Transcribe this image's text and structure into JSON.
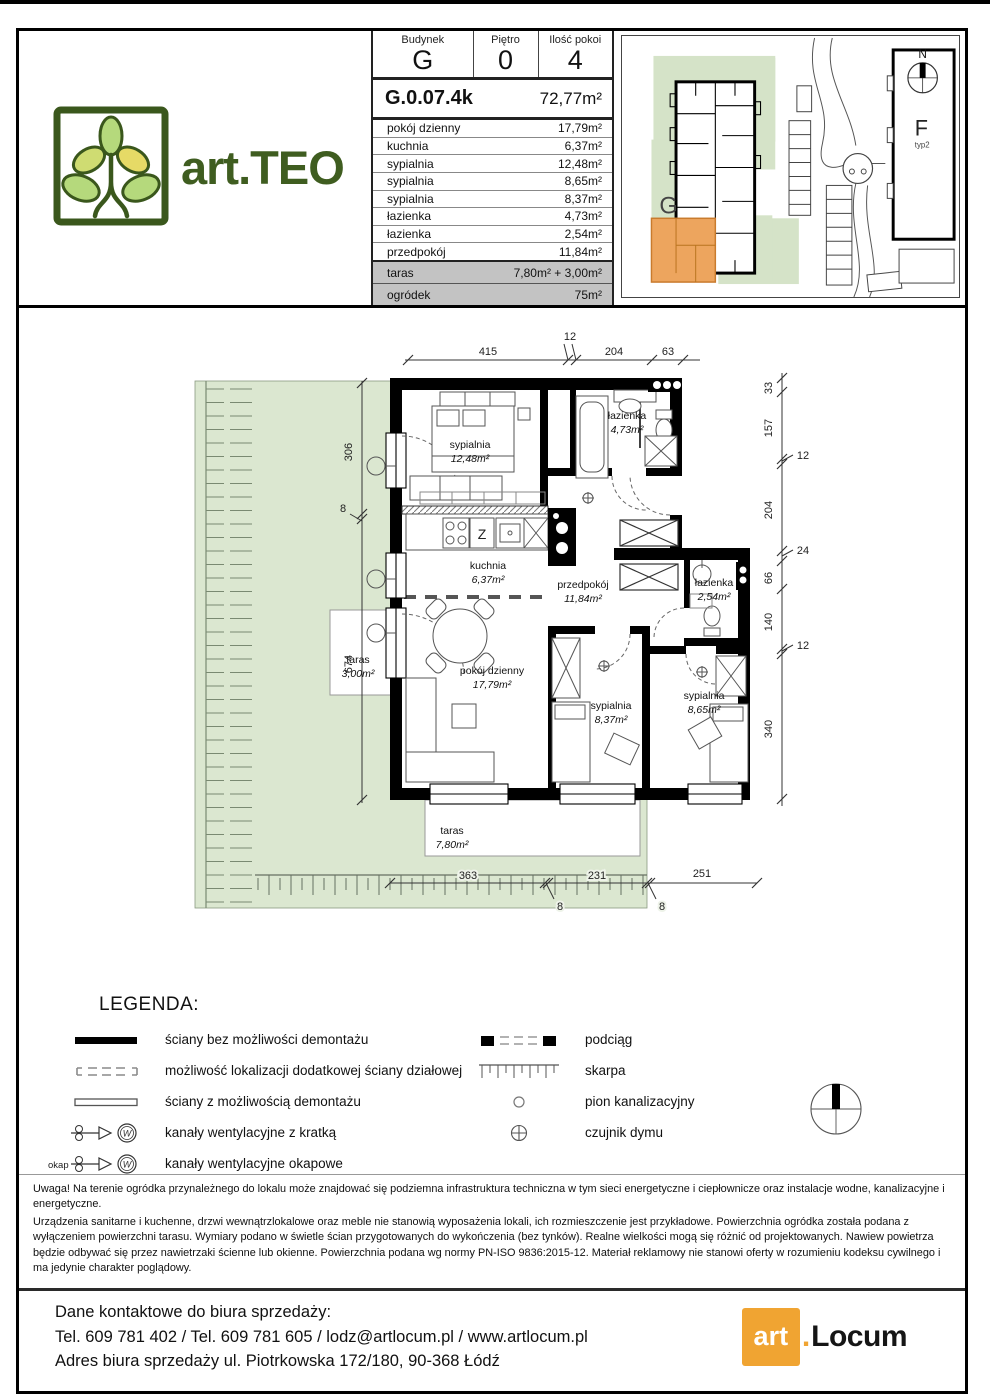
{
  "header": {
    "logo_text": "art.TEO",
    "info_table": {
      "building_label": "Budynek",
      "building_value": "G",
      "floor_label": "Piętro",
      "floor_value": "0",
      "rooms_label": "Ilość pokoi",
      "rooms_value": "4",
      "unit_id": "G.0.07.4k",
      "unit_area": "72,77m²",
      "rows": [
        {
          "label": "pokój dzienny",
          "value": "17,79m²"
        },
        {
          "label": "kuchnia",
          "value": "6,37m²"
        },
        {
          "label": "sypialnia",
          "value": "12,48m²"
        },
        {
          "label": "sypialnia",
          "value": "8,65m²"
        },
        {
          "label": "sypialnia",
          "value": "8,37m²"
        },
        {
          "label": "łazienka",
          "value": "4,73m²"
        },
        {
          "label": "łazienka",
          "value": "2,54m²"
        },
        {
          "label": "przedpokój",
          "value": "11,84m²"
        }
      ],
      "taras_label": "taras",
      "taras_value": "7,80m² + 3,00m²",
      "garden_label": "ogródek",
      "garden_value": "75m²"
    },
    "site_plan": {
      "building_g_label": "G",
      "building_f_label": "F",
      "building_f_sublabel": "typ2",
      "north_label": "N",
      "highlight_color": "#eda55e",
      "garden_color": "#d5e3c8"
    }
  },
  "floor_plan": {
    "garden_color": "#dbe7d0",
    "rooms": [
      {
        "name": "sypialnia",
        "area": "12,48m²"
      },
      {
        "name": "łazienka",
        "area": "4,73m²"
      },
      {
        "name": "kuchnia",
        "area": "6,37m²"
      },
      {
        "name": "przedpokój",
        "area": "11,84m²"
      },
      {
        "name": "łazienka",
        "area": "2,54m²"
      },
      {
        "name": "pokój dzienny",
        "area": "17,79m²"
      },
      {
        "name": "sypialnia",
        "area": "8,37m²"
      },
      {
        "name": "sypialnia",
        "area": "8,65m²"
      },
      {
        "name": "taras",
        "area": "3,00m²"
      },
      {
        "name": "taras",
        "area": "7,80m²"
      }
    ],
    "kitchen_sink_label": "Z",
    "dims_top": [
      "415",
      "12",
      "204",
      "63"
    ],
    "dims_right": [
      "33",
      "157",
      "12",
      "204",
      "24",
      "66",
      "140",
      "12",
      "340"
    ],
    "dims_left": [
      "306",
      "8",
      "674"
    ],
    "dims_bottom": [
      "363",
      "8",
      "231",
      "8",
      "251"
    ]
  },
  "legend": {
    "title": "LEGENDA:",
    "left": [
      "ściany bez możliwości demontażu",
      "możliwość lokalizacji dodatkowej ściany działowej",
      "ściany z możliwością demontażu",
      "kanały wentylacyjne z kratką",
      "kanały wentylacyjne okapowe"
    ],
    "okap_label": "okap",
    "vent_letter": "W",
    "right": [
      "podciąg",
      "skarpa",
      "pion kanalizacyjny",
      "czujnik dymu"
    ]
  },
  "disclaimer": {
    "p1": "Uwaga! Na terenie ogródka przynależnego do lokalu może znajdować się podziemna infrastruktura techniczna w tym sieci energetyczne i ciepłownicze oraz instalacje wodne, kanalizacyjne i energetyczne.",
    "p2": "Urządzenia sanitarne i kuchenne, drzwi wewnątrzlokalowe oraz meble nie stanowią wyposażenia lokali, ich rozmieszczenie jest przykładowe. Powierzchnia ogródka została podana z wyłączeniem powierzchni tarasu. Wymiary podano w świetle ścian przygotowanych do wykończenia (bez tynków). Realne wielkości mogą się różnić od projektowanych. Nawiew powietrza będzie odbywać się przez nawietrzaki ścienne lub okienne. Powierzchnia podana wg normy PN-ISO 9836:2015-12. Materiał reklamowy nie stanowi oferty w rozumieniu kodeksu cywilnego i ma jedynie charakter poglądowy."
  },
  "footer": {
    "line1": "Dane kontaktowe do biura sprzedaży:",
    "line2": "Tel. 609 781 402 / Tel. 609 781 605 / lodz@artlocum.pl / www.artlocum.pl",
    "line3": "Adres biura sprzedaży ul. Piotrkowska 172/180, 90-368 Łódź",
    "logo_art": "art",
    "logo_dot": ".",
    "logo_locum": "Locum",
    "logo_color": "#f0a432"
  }
}
